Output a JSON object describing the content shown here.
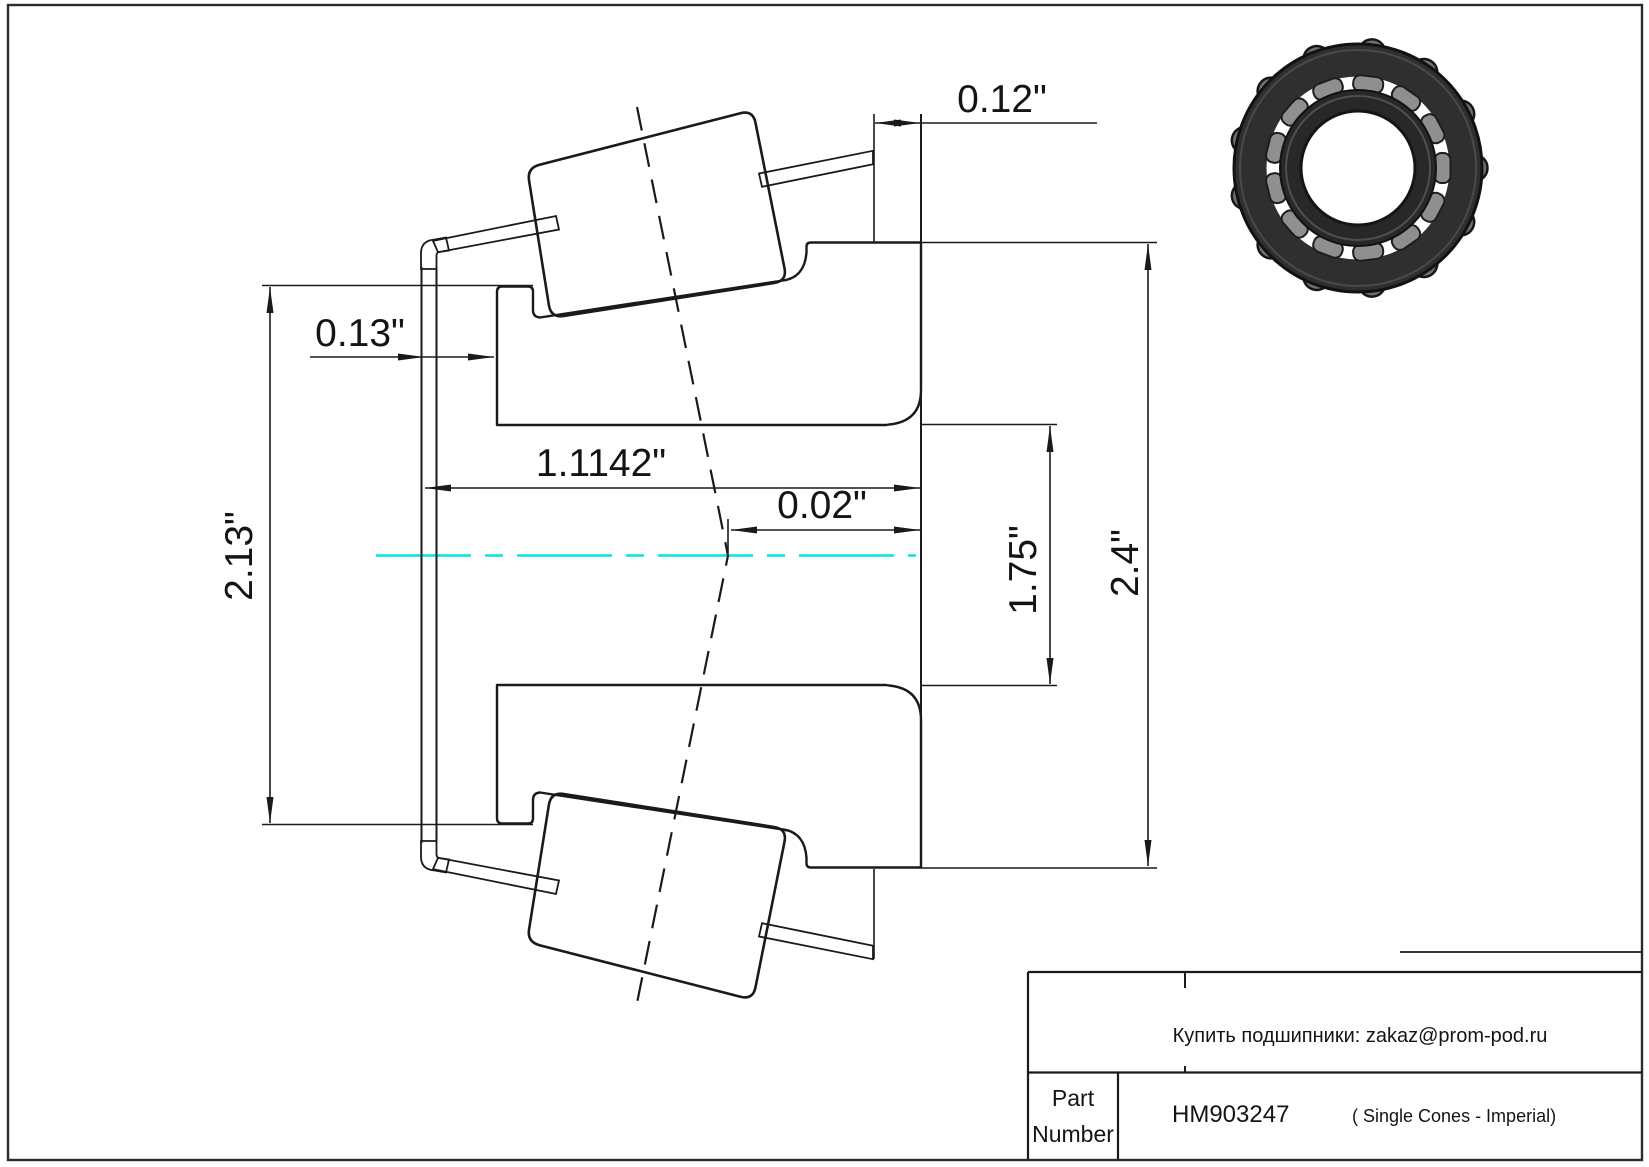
{
  "title_block": {
    "order_line": "Купить подшипники: zakaz@prom-pod.ru",
    "part_label_line1": "Part",
    "part_label_line2": "Number",
    "part_number": "HM903247",
    "series_note": "( Single Cones - Imperial)"
  },
  "dimensions": {
    "cage_overhang": "0.12\"",
    "front_offset": "0.13\"",
    "front_rib_od": "2.13\"",
    "cone_width": "1.1142\"",
    "apex_offset": "0.02\"",
    "bore_diameter": "1.75\"",
    "back_rib_od": "2.4\""
  },
  "colors": {
    "line": "#1a1a1a",
    "centerline": "#00e6e6",
    "bearing_dark": "#2f2f2f",
    "bearing_roller": "#8f8f8f"
  }
}
